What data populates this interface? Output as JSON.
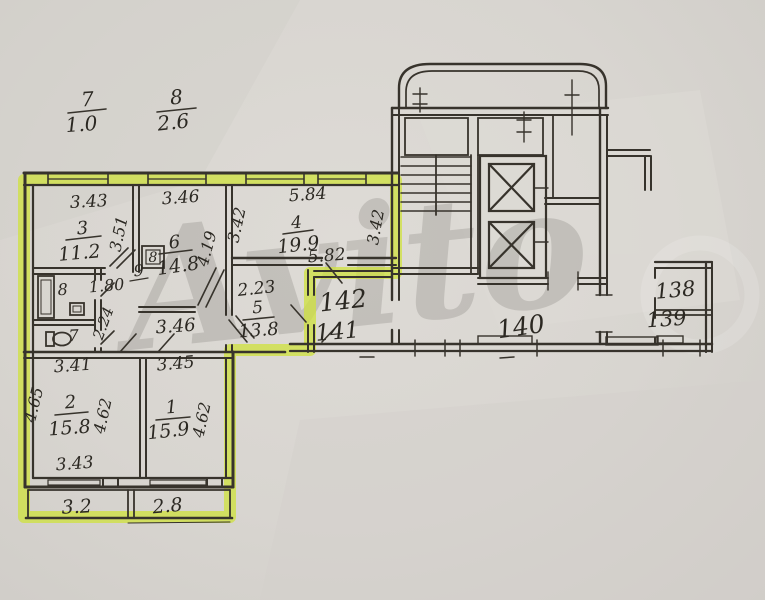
{
  "plan": {
    "title_note": "apartment floor plan, highlighted unit",
    "watermark": "Avito",
    "colors": {
      "highlight": "#cfe23c",
      "ink": "#37332c",
      "paper": "#d8d5d0"
    },
    "refs_top": {
      "left_num": "7",
      "left_val": "1.0",
      "right_num": "8",
      "right_val": "2.6"
    },
    "rooms": {
      "r3": {
        "num": "3",
        "area": "11.2",
        "w": "3.43",
        "h": "3.51"
      },
      "r6": {
        "num": "6",
        "area": "14.8",
        "w": "3.46",
        "h": "4.19",
        "vent": "8"
      },
      "r4": {
        "num": "4",
        "area": "19.9",
        "w_top": "5.84",
        "w_bot": "5.82",
        "h_left": "3.42",
        "h_right": "3.42"
      },
      "r5": {
        "num": "5",
        "area": "13.8",
        "w": "2.23"
      },
      "r9": {
        "num": "9",
        "w": "1.80",
        "corr": "3.46",
        "h": "2.24"
      },
      "r8": {
        "num": "8"
      },
      "r7": {
        "num": "7"
      },
      "r2": {
        "num": "2",
        "area": "15.8",
        "w_top": "3.41",
        "w_bot": "3.43",
        "h_left": "4.65",
        "h_right": "4.62"
      },
      "r1": {
        "num": "1",
        "area": "15.9",
        "w_top": "3.45",
        "h_right": "4.62"
      }
    },
    "balconies": {
      "left": "3.2",
      "right": "2.8"
    },
    "common": {
      "hall_a": "142",
      "hall_b": "141",
      "corridor": "140",
      "flat_a": "138",
      "flat_b": "139"
    }
  }
}
